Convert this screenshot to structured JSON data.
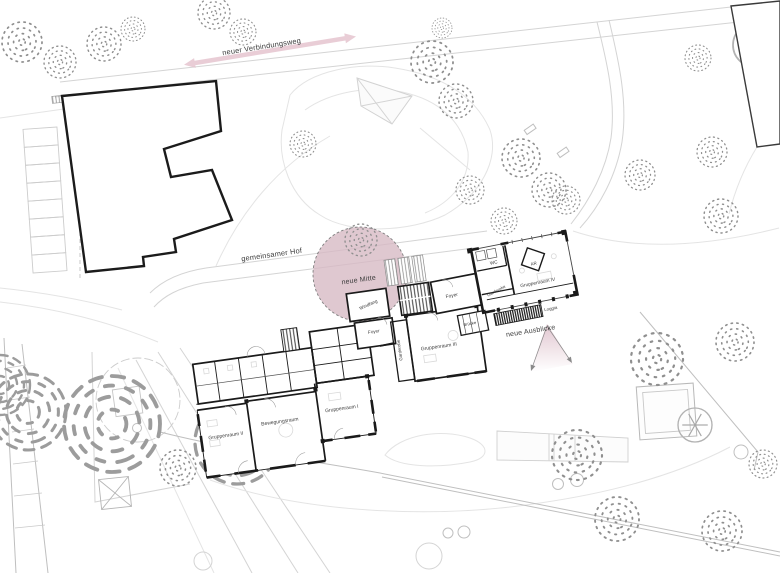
{
  "annotations": {
    "verbindungsweg": "neuer Verbindungsweg",
    "hof": "gemeinsamer Hof",
    "mitte": "neue Mitte",
    "ausblicke": "neue Ausblicke"
  },
  "rooms": {
    "left_wing": {
      "gruppenraum2": "Gruppenraum II",
      "bewegungsraum": "Bewegungsraum",
      "gruppenraum1": "Gruppenraum I"
    },
    "middle_wing": {
      "windfang": "Windfang",
      "foyer": "Foyer",
      "garderobe": "Garderobe",
      "gruppenraum3": "Gruppenraum III"
    },
    "right_wing": {
      "foyer": "Foyer",
      "bruecke": "Brücke",
      "wc": "WC",
      "ar": "AR",
      "garderobe": "Garderobe",
      "gruppenraum4": "Gruppenraum IV",
      "loggia": "Loggia"
    }
  },
  "colors": {
    "accent_pink": "#e2bcc8",
    "circle_fill": "#d7b9c4",
    "cone_pink": "#ddbfca",
    "wall_black": "#1a1a1a",
    "site_line": "#dcdcdc",
    "text": "#3c3c3c"
  }
}
